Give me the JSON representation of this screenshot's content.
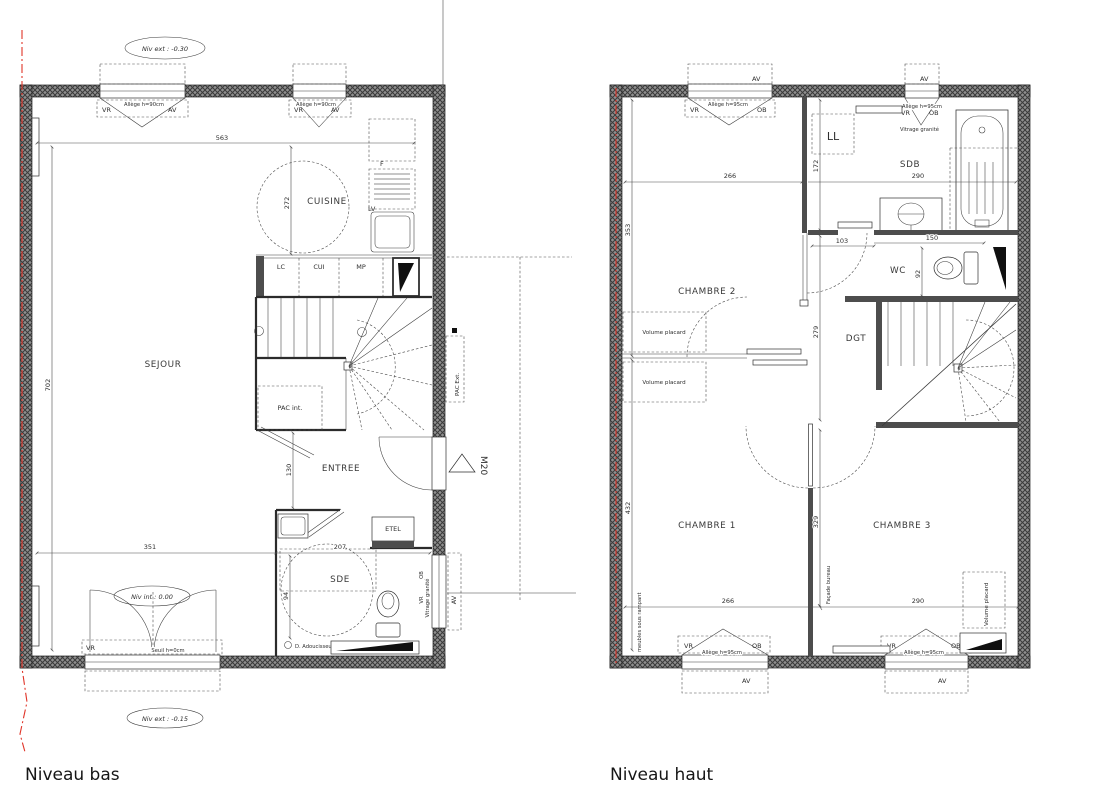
{
  "titles": {
    "bas": "Niveau bas",
    "haut": "Niveau haut"
  },
  "common": {
    "vr": "VR",
    "av": "AV",
    "ob": "OB",
    "allege90": "Allège h=90cm",
    "allege95": "Allège h=95cm",
    "vitrage": "Vitrage granité",
    "seuil": "Seuil h=0cm"
  },
  "bas": {
    "levels": {
      "ext_top": "Niv ext : -0.30",
      "int": "Niv int : 0.00",
      "ext_bottom": "Niv ext : -0.15"
    },
    "rooms": {
      "sejour": "SEJOUR",
      "cuisine": "CUISINE",
      "entree": "ENTREE",
      "sde": "SDE"
    },
    "equip": {
      "lc": "LC",
      "cui": "CUI",
      "mp": "MP",
      "f": "F",
      "lv": "LV",
      "etel": "ETEL",
      "pac_int": "PAC int.",
      "pac_ext": "PAC Ext.",
      "m20": "M20",
      "adoucisseur": "D. Adoucisseur"
    },
    "dims": {
      "top": "563",
      "kitchen_h": "272",
      "left_h": "702",
      "sejour_w": "351",
      "sde_w": "207",
      "entree_h": "130",
      "sde_h": "94"
    }
  },
  "haut": {
    "rooms": {
      "ch1": "CHAMBRE 1",
      "ch2": "CHAMBRE 2",
      "ch3": "CHAMBRE 3",
      "sdb": "SDB",
      "wc": "WC",
      "dgt": "DGT",
      "ll": "LL"
    },
    "equip": {
      "placard": "Volume placard",
      "facade": "Façade bureau",
      "meubles": "meubles sous rampant"
    },
    "dims": {
      "ch2_w": "266",
      "sdb_w": "290",
      "ch2_h": "353",
      "ll_h": "172",
      "door_w": "103",
      "wc_w": "150",
      "wc_h": "92",
      "dgt_h": "279",
      "mid_h": "329",
      "ch1_h": "432",
      "ch1_w": "266",
      "ch3_w": "290"
    }
  }
}
